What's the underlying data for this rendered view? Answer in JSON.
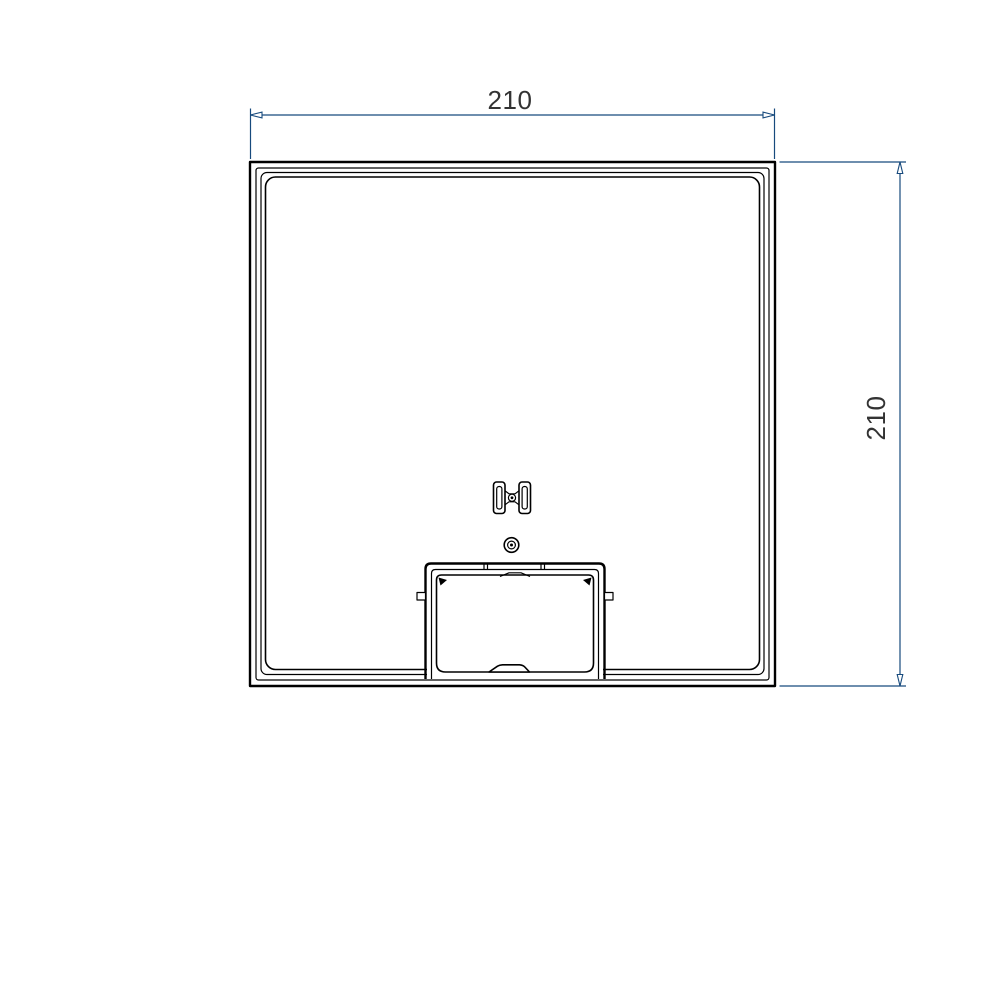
{
  "drawing": {
    "background": "#ffffff",
    "view": "square-panel-with-bottom-hatch-top-view"
  },
  "colors": {
    "part_line": "#000000",
    "dimension_line": "#174a7d",
    "dimension_text": "#333333"
  },
  "dimensions": {
    "width": {
      "value": "210"
    },
    "height": {
      "value": "210"
    }
  }
}
